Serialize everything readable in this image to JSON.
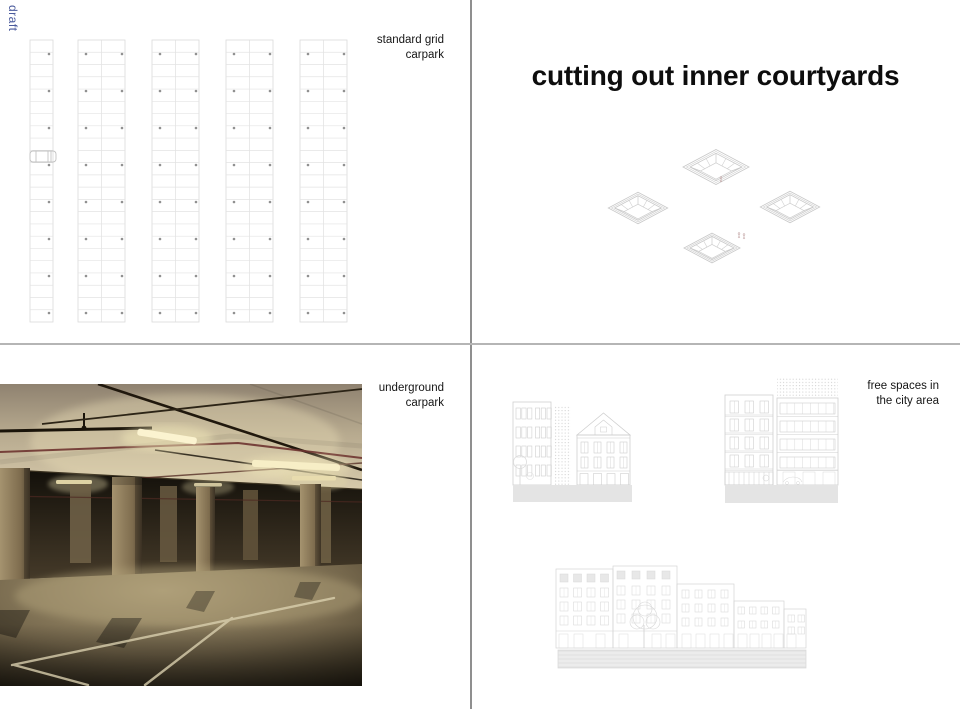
{
  "watermark": {
    "text": "draft",
    "color": "#4a5a9c"
  },
  "panels": {
    "standard_grid": {
      "caption_lines": [
        "standard grid",
        "carpark"
      ]
    },
    "courtyards": {
      "title": "cutting out inner courtyards"
    },
    "underground": {
      "caption_lines": [
        "underground",
        "carpark"
      ]
    },
    "free_spaces": {
      "caption_lines": [
        "free spaces in",
        "the city area"
      ]
    }
  },
  "drawings": {
    "parking_grid": "standard-parking-grid-plan-with-car",
    "courtyards_isometric": "four-isometric-courtyard-cutouts",
    "street_elevations": "building-elevations-with-stippled-free-spaces"
  },
  "colors": {
    "divider": "#8f8f8f",
    "drawing_line": "#cccccc",
    "ground_fill": "#e4e4e4"
  }
}
